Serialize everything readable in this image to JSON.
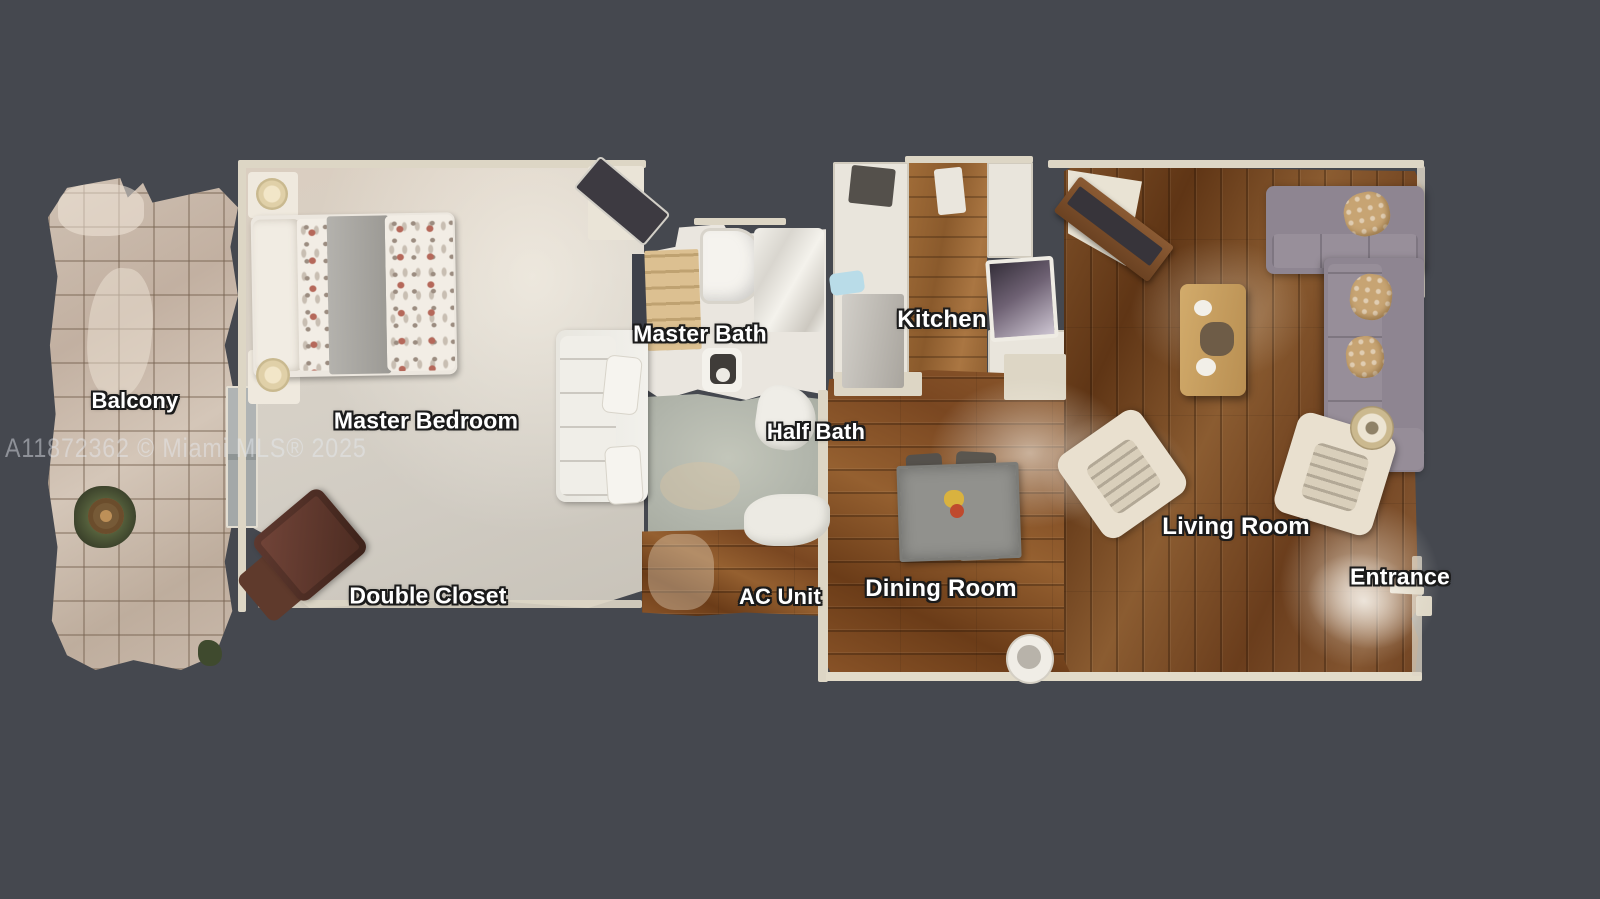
{
  "watermark": "A11872362 © Miami MLS® 2025",
  "rooms": [
    {
      "name": "balcony",
      "label": "Balcony"
    },
    {
      "name": "master-bedroom",
      "label": "Master Bedroom"
    },
    {
      "name": "master-bath",
      "label": "Master Bath"
    },
    {
      "name": "kitchen",
      "label": "Kitchen"
    },
    {
      "name": "half-bath",
      "label": "Half Bath"
    },
    {
      "name": "double-closet",
      "label": "Double Closet"
    },
    {
      "name": "ac-unit",
      "label": "AC Unit"
    },
    {
      "name": "dining-room",
      "label": "Dining Room"
    },
    {
      "name": "living-room",
      "label": "Living Room"
    },
    {
      "name": "entrance",
      "label": "Entrance"
    }
  ],
  "colors": {
    "background": "#45484f",
    "label_fill": "#ffffff",
    "label_outline": "#1b1b1b",
    "watermark": "rgba(230,234,242,0.45)",
    "wood_living": "#7e5028",
    "wood_dining": "#8a5428",
    "wood_kitchen": "#a06c38",
    "balcony_tile": "#c6b5a7",
    "carpet": "#d6d0c6",
    "bath_floor": "#eae6df",
    "utility_floor": "#b1b5ab",
    "sofa_gray": "#8e8591",
    "cream_furniture": "#e9e3d4"
  }
}
